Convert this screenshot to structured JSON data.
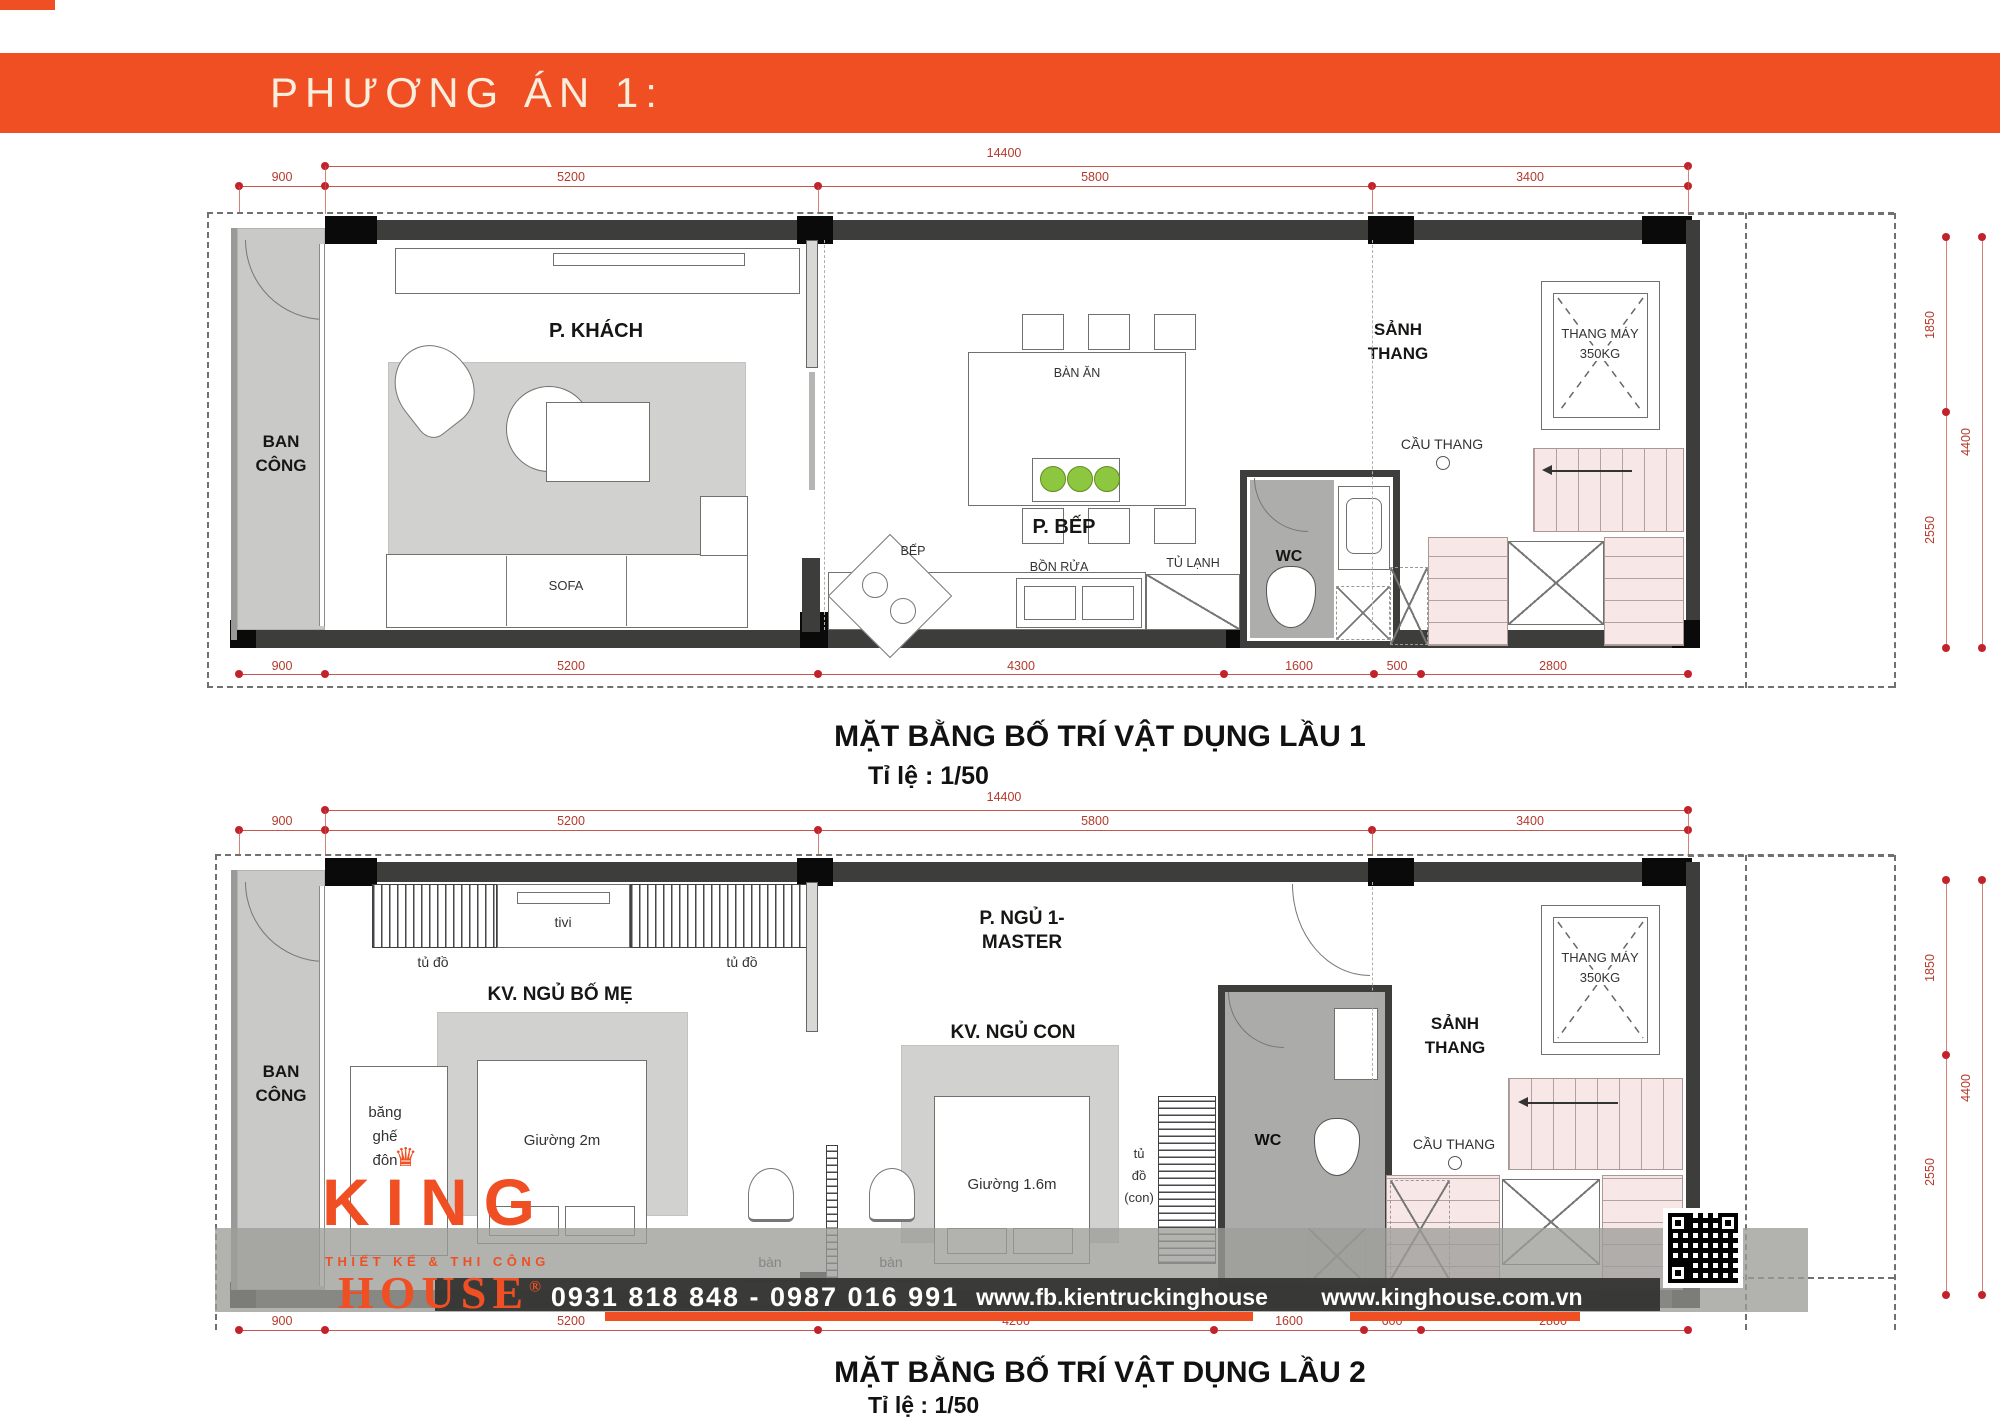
{
  "header": {
    "title": "PHƯƠNG ÁN 1:"
  },
  "colors": {
    "accent": "#F04F23",
    "dim_red": "#B5392C",
    "wall": "#3D3D3B",
    "stair_pink": "#F7E7E6",
    "plant_green": "#8DC63F"
  },
  "plan1": {
    "title": "MẶT BẰNG BỐ TRÍ VẬT DỤNG LẦU 1",
    "scale_label": "Tỉ lệ : 1/50",
    "dim_total": "14400",
    "dims_top": [
      "900",
      "5200",
      "5800",
      "3400"
    ],
    "dims_bottom": [
      "900",
      "5200",
      "4300",
      "1600",
      "500",
      "2800"
    ],
    "dims_right": [
      "1850",
      "4400",
      "2550"
    ],
    "labels": {
      "balcony": [
        "BAN",
        "CÔNG"
      ],
      "living": "P. KHÁCH",
      "sofa": "SOFA",
      "dining_table": "BÀN ĂN",
      "kitchen": "P. BẾP",
      "stove": "BẾP",
      "sink": "BỒN RỬA",
      "fridge": "TỦ LẠNH",
      "wc": "WC",
      "stair_hall": [
        "SẢNH",
        "THANG"
      ],
      "elevator": [
        "THANG MÁY",
        "350KG"
      ],
      "stairs": "CẦU THANG"
    }
  },
  "plan2": {
    "title": "MẶT BẰNG BỐ TRÍ VẬT DỤNG LẦU 2",
    "scale_label": "Tỉ lệ : 1/50",
    "dim_total": "14400",
    "dims_top": [
      "900",
      "5200",
      "5800",
      "3400"
    ],
    "dims_bottom": [
      "900",
      "5200",
      "4200",
      "1600",
      "600",
      "2800"
    ],
    "dims_right": [
      "1850",
      "4400",
      "2550"
    ],
    "labels": {
      "balcony": [
        "BAN",
        "CÔNG"
      ],
      "bench": [
        "băng",
        "ghế",
        "đôn"
      ],
      "wardrobe_left": "tủ đồ",
      "tv": "tivi",
      "wardrobe_right": "tủ đồ",
      "parents_zone": "KV. NGỦ BỐ MẸ",
      "bed_parents": "Giường 2m",
      "master": [
        "P. NGỦ 1-",
        "MASTER"
      ],
      "kid_zone": "KV. NGỦ CON",
      "bed_kid": "Giường 1.6m",
      "desk_1": "bàn",
      "desk_2": "bàn",
      "wardrobe_kid": [
        "tủ",
        "đồ",
        "(con)"
      ],
      "wc": "WC",
      "stair_hall": [
        "SẢNH",
        "THANG"
      ],
      "elevator": [
        "THANG MÁY",
        "350KG"
      ],
      "stairs": "CẦU THANG"
    }
  },
  "footer": {
    "brand_name_top": "KING",
    "brand_tagline": "THIẾT KẾ & THI CÔNG",
    "brand_name_bottom": "HOUSE",
    "brand_reg": "®",
    "phone": "0931 818 848 - 0987 016 991",
    "facebook_url": "www.fb.kientruckinghouse",
    "website_url": "www.kinghouse.com.vn"
  }
}
